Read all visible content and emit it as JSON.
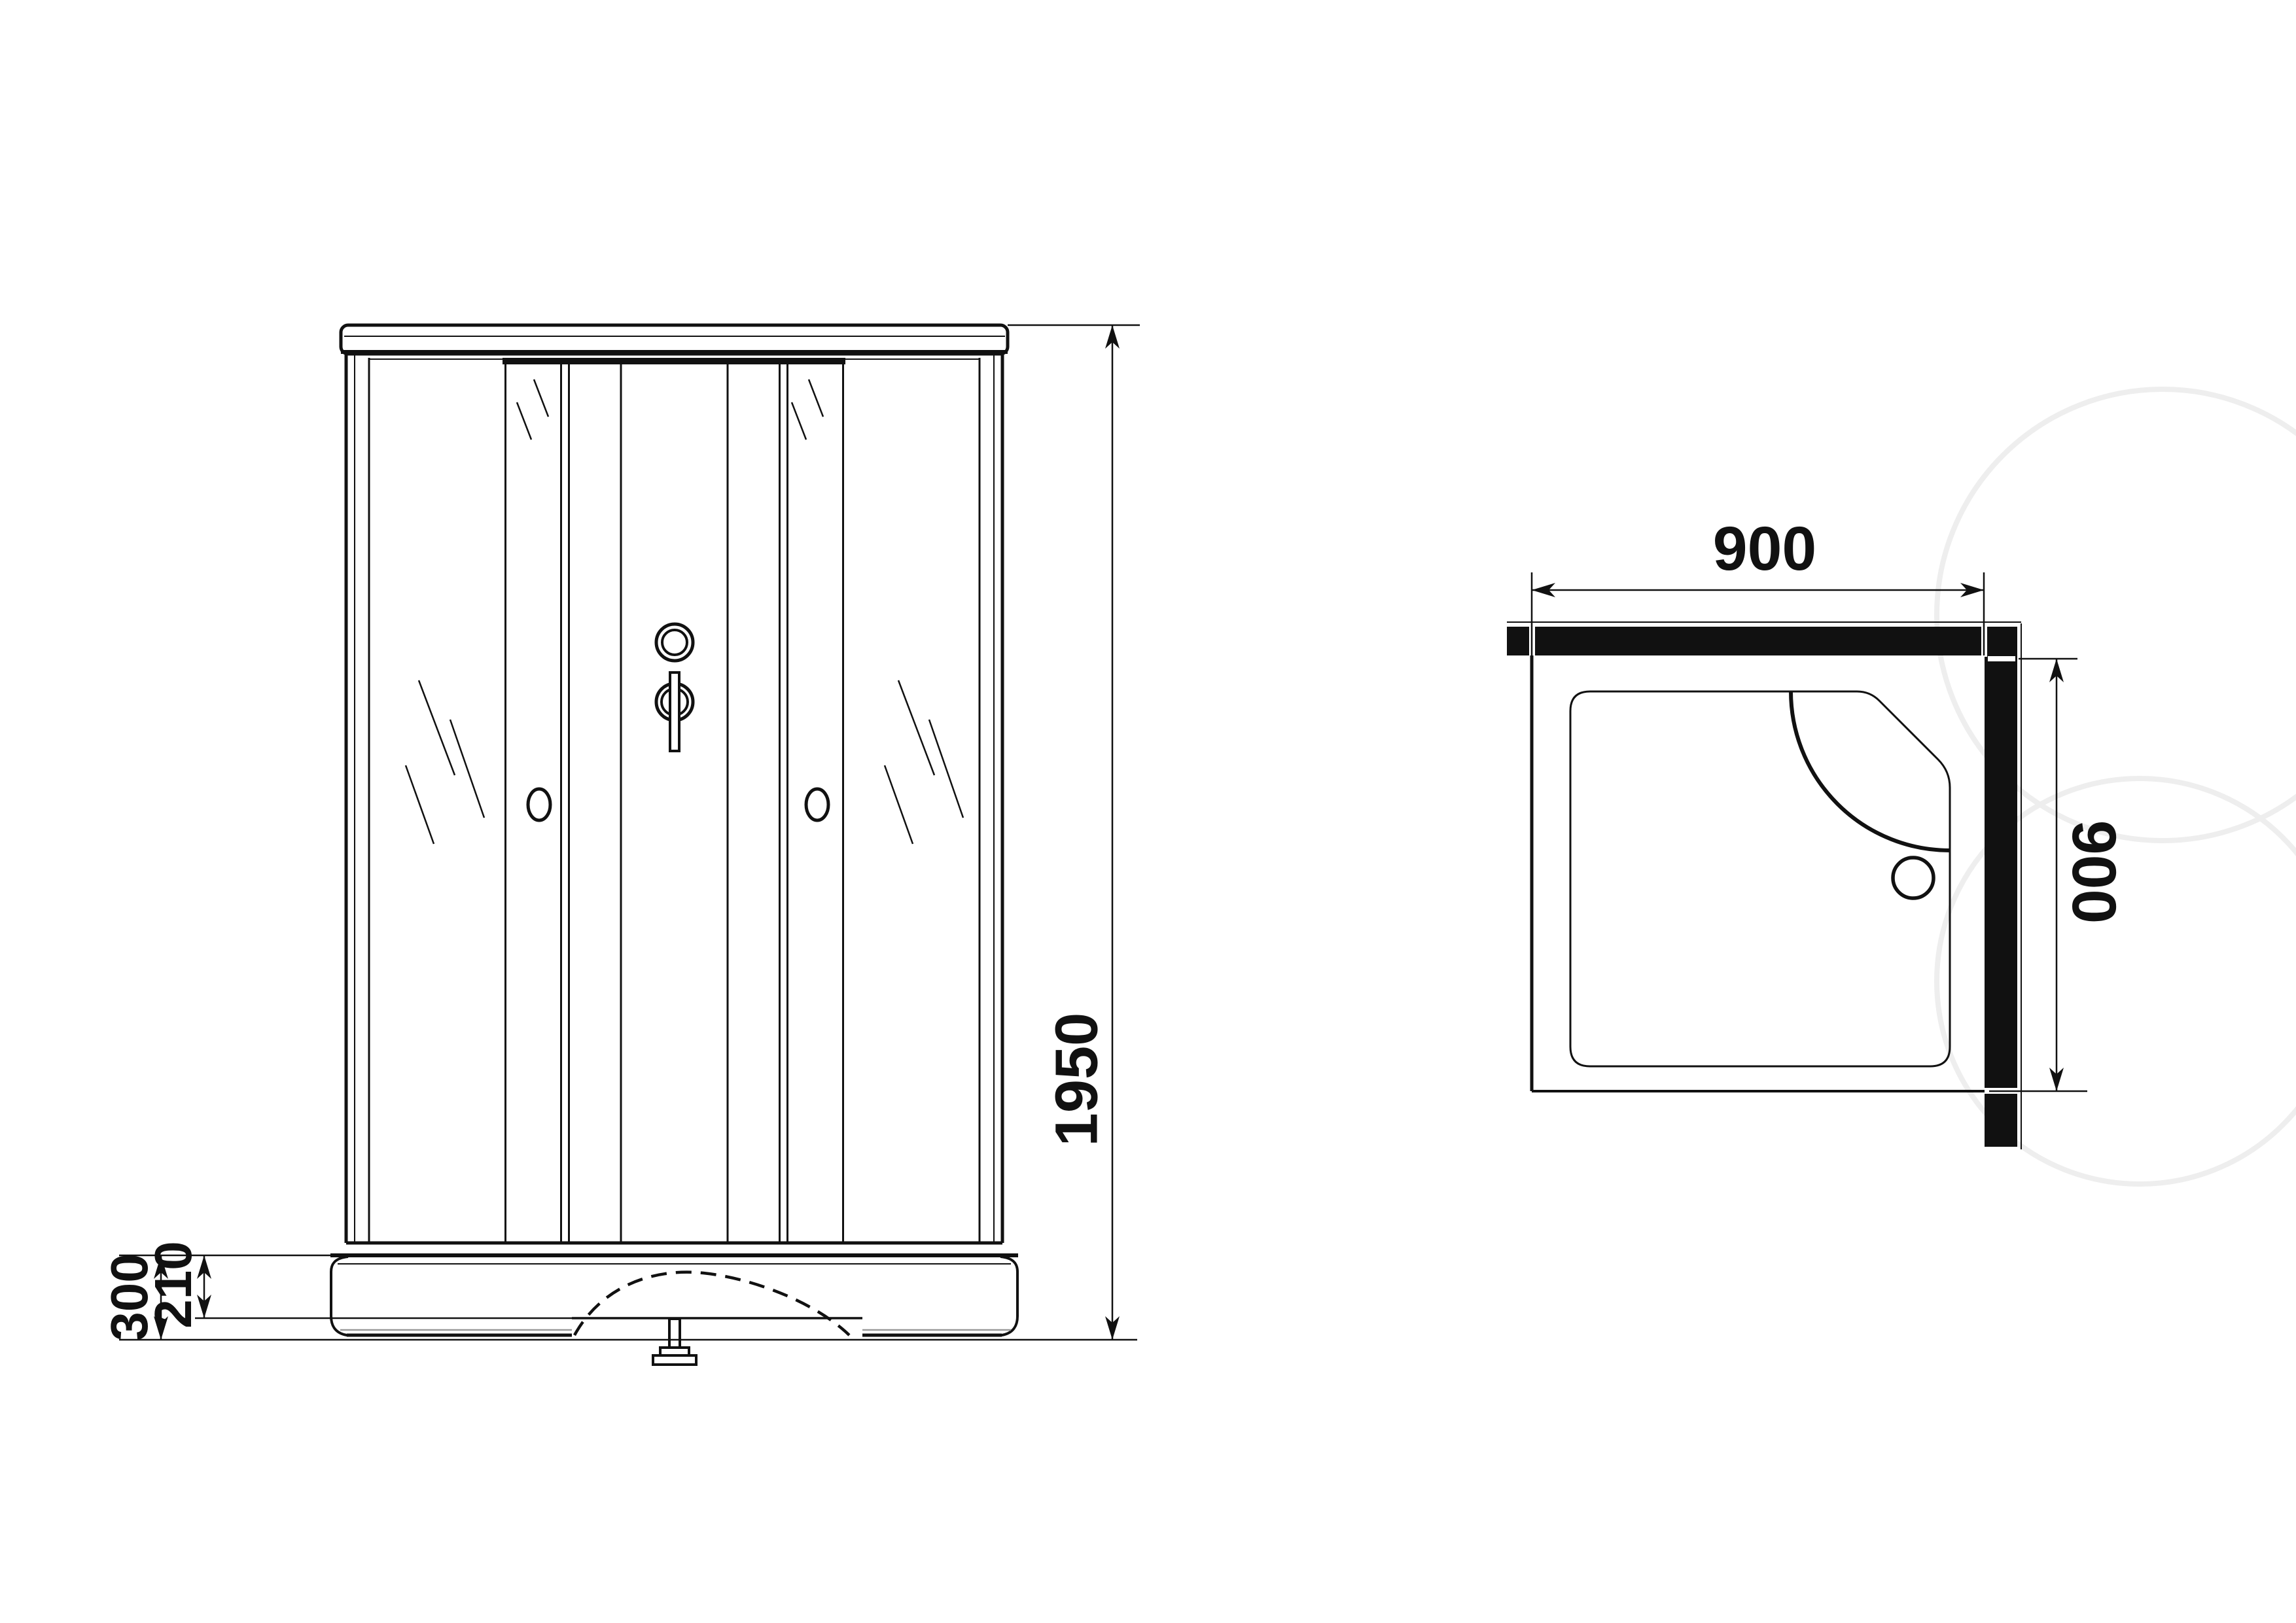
{
  "drawing": {
    "type": "shower-cabin technical drawing",
    "views": {
      "front_view": {
        "name": "front elevation",
        "dimensions": {
          "total_height": {
            "value": "1950",
            "orientation": "vertical"
          },
          "base_height": {
            "value": "300",
            "orientation": "vertical"
          },
          "tray_height": {
            "value": "210",
            "orientation": "vertical"
          }
        }
      },
      "plan_view": {
        "name": "top plan view",
        "dimensions": {
          "width": {
            "value": "900",
            "orientation": "horizontal"
          },
          "depth": {
            "value": "900",
            "orientation": "vertical-rotated"
          }
        }
      }
    },
    "colors": {
      "ink": "#111111",
      "background": "#ffffff",
      "gray_detail": "#9a9a9a",
      "watermark": "#eeeeee"
    }
  }
}
